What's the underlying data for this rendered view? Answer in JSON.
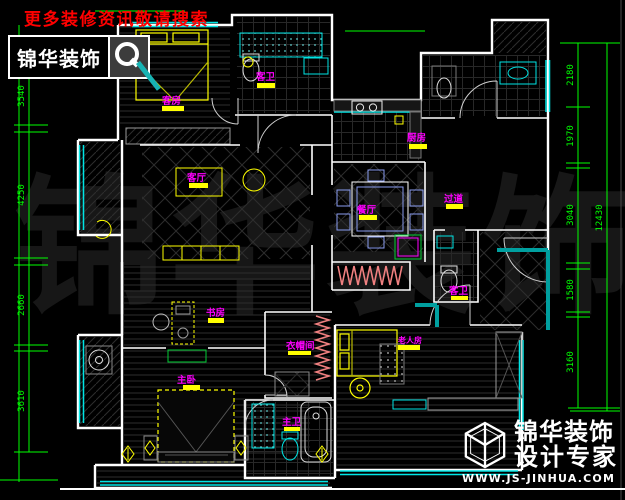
{
  "header": {
    "search_notice": "更多装修资讯敬请搜索",
    "logo_text": "锦华装饰"
  },
  "footer": {
    "brand": "锦华装饰",
    "tagline": "设计专家",
    "url": "WWW.JS-JINHUA.COM"
  },
  "watermark": {
    "text": "锦华装饰"
  },
  "dimensions": {
    "left": [
      "3540",
      "4250",
      "2660",
      "3610"
    ],
    "right": [
      "2180",
      "1970",
      "3040",
      "1580",
      "3160"
    ],
    "right_total": "12430"
  },
  "rooms": {
    "guest_bedroom": "客房",
    "living": "客厅",
    "guest_bath_top": "客卫",
    "kitchen": "厨房",
    "dining": "餐厅",
    "hallway": "过道",
    "guest_bath_mid": "客卫",
    "study": "书房",
    "master_bedroom": "主卧",
    "closet": "衣帽间",
    "master_bath": "主卫",
    "elder_room": "老人房"
  },
  "colors": {
    "dimension_green": "#00ff00",
    "label_magenta": "#ff00ff",
    "furniture_yellow": "#ffff00",
    "fixture_cyan": "#00e5e5",
    "wall_white": "#ffffff",
    "notice_red": "#ff0000",
    "hanger_pink": "#f08080",
    "cabinet_green": "#00cc33"
  }
}
